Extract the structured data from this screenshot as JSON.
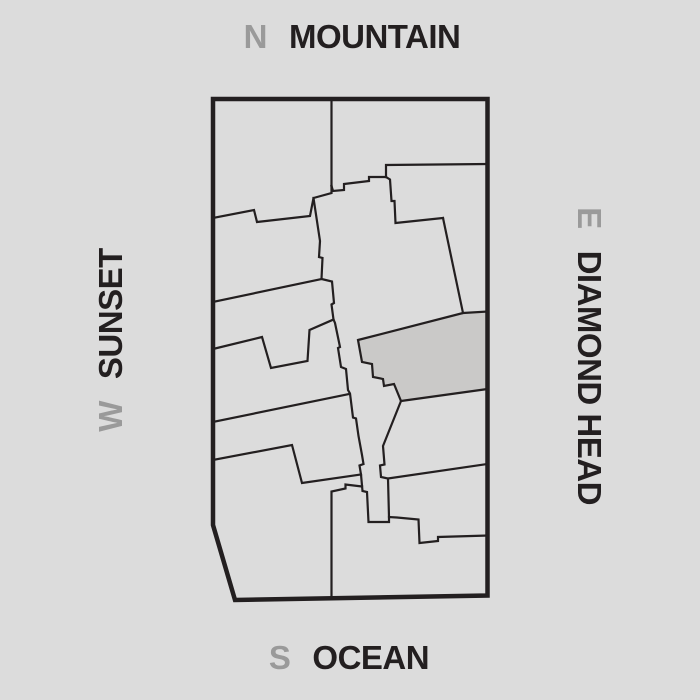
{
  "compass": {
    "north": {
      "letter": "N",
      "label": "MOUNTAIN"
    },
    "south": {
      "letter": "S",
      "label": "OCEAN"
    },
    "west": {
      "letter": "W",
      "label": "SUNSET"
    },
    "east": {
      "letter": "E",
      "label": "DIAMOND HEAD"
    }
  },
  "colors": {
    "background": "#dcdcdc",
    "line": "#231f20",
    "letter_gray": "#9a9a9a",
    "highlight_fill": "#cac9c8"
  },
  "plan": {
    "outer": {
      "name": "plan-outer-boundary",
      "points": "213,99 487.5,99 487.5,595.5 235,600 213,525",
      "stroke_width": 4.5
    },
    "highlight": {
      "name": "highlighted-unit",
      "points": "358,340 463,313 487.5,311.5 487.5,389 401,401 394,384 384,386 383,379 373,377 372,364 362,362"
    },
    "lines": [
      {
        "name": "divider-top-vertical",
        "points": "331.5,99 331.5,186"
      },
      {
        "name": "divider-core-north-steps",
        "points": "331.5,186 333,191 344,190 344,184 369,181 369,177 386,177"
      },
      {
        "name": "divider-east-horizontal",
        "points": "386,177 386,165 487.5,164"
      },
      {
        "name": "divider-center-ne-zigzag",
        "points": "386,177 390,179.5 391.5,201 394.5,201 395.5,223 443,218"
      },
      {
        "name": "divider-east-diagonal",
        "points": "443,218 463,313"
      },
      {
        "name": "divider-core-west-jagged",
        "points": "331.5,186 331.5,193 313.5,198 320,241 319,257 322.5,258 321.5,279 332,281.5 334,303 331.5,304.5 333.5,319.5 335,323 340,347 338,348 341,367 346,369 348,390 350,393.5 353,417.5 356,418.5 358.5,436 362,455 363.5,464 359.5,465.5 361,474.5 362.5,491 367,492 368.5,522 389,522 389,517 397,517.5 418.5,519.5 419.5,543 438,541 438,537 487.5,535.5"
      },
      {
        "name": "divider-core-east-lower",
        "points": "401,401 383,446 384.5,464.5 380,465.5 381,477 388,478.5 389,517"
      },
      {
        "name": "divider-southeast-diagonal",
        "points": "388,478.5 487.5,464"
      },
      {
        "name": "divider-west-1",
        "points": "213,218 254,210 257,222 310,216 313.5,198"
      },
      {
        "name": "divider-west-2",
        "points": "213,302 321.5,279"
      },
      {
        "name": "divider-west-3-notch",
        "points": "213,349 262,337 271,368 307.5,361 309.5,330 333.5,319.5"
      },
      {
        "name": "divider-west-4",
        "points": "213,422 349,394"
      },
      {
        "name": "divider-west-5",
        "points": "213,460 292,445 302,483 361,474.5"
      },
      {
        "name": "divider-bottom-vertical",
        "points": "331.5,597.5 331.5,491.5 345.5,488.5 345.5,484.5 362,486.5"
      }
    ]
  }
}
